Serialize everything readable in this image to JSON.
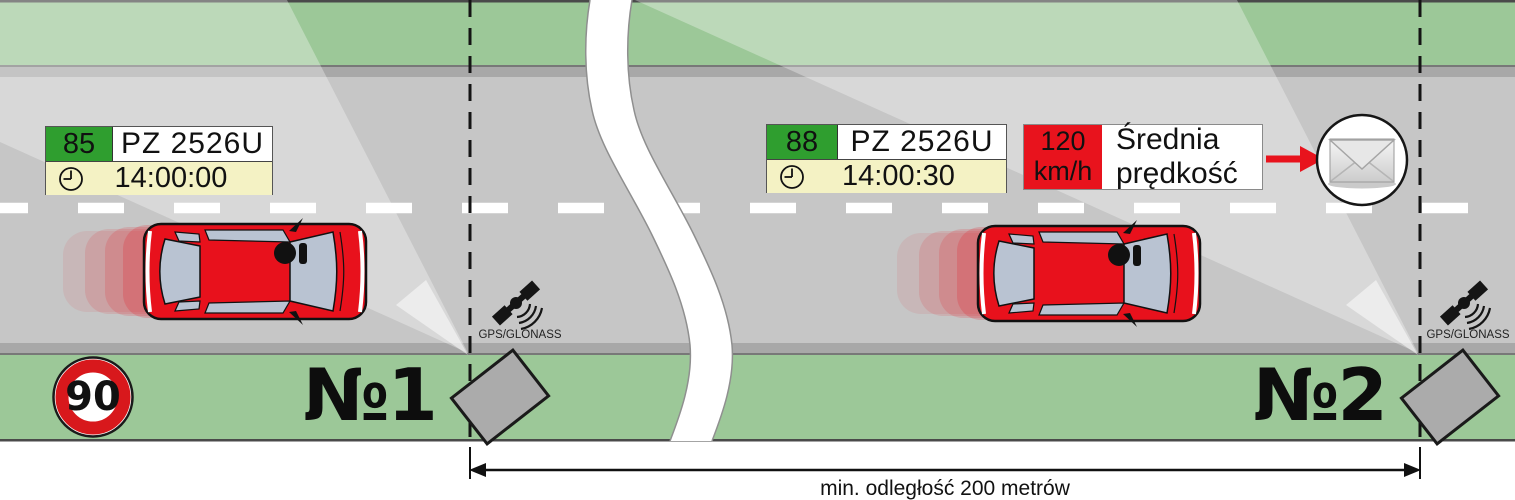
{
  "diagram": {
    "speed_limit_sign": "90",
    "distance_label": "min. odległość 200 metrów"
  },
  "checkpoint1": {
    "label": "№1",
    "gps_label": "GPS/GLONASS",
    "speed": "85",
    "plate": "PZ 2526U",
    "time": "14:00:00"
  },
  "checkpoint2": {
    "label": "№2",
    "gps_label": "GPS/GLONASS",
    "speed": "88",
    "plate": "PZ 2526U",
    "time": "14:00:30"
  },
  "result": {
    "avg_value": "120",
    "avg_unit": "km/h",
    "label_line1": "Średnia",
    "label_line2": "prędkość"
  },
  "icons": {
    "clock_icon": "analog clock face",
    "envelope_icon": "mail envelope in circle",
    "satellite_icon": "satellite with signal waves",
    "camera_icon": "gray tilted camera housing"
  },
  "colors": {
    "accent_red": "#e8131d",
    "grass_green": "#9cc898",
    "road_gray": "#c6c6c6",
    "curb_gray": "#a8a8a8",
    "plate_green": "#2f9e2f",
    "time_row_bg": "#f4f2c4",
    "sign_ring_red": "#d8181c",
    "car_window_blue": "#b9c3d2"
  }
}
